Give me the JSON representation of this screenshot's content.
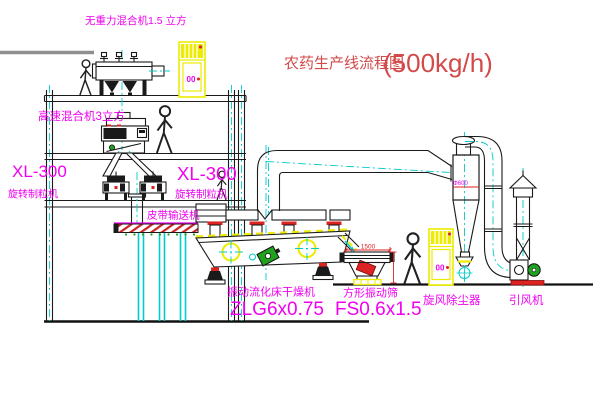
{
  "title": {
    "text": "农药生产线流程图",
    "capacity": "(500kg/h)"
  },
  "equipment_labels": {
    "gravity_mixer": "无重力混合机1.5 立方",
    "high_speed_mixer": "高速混合机3立方",
    "granulator_left": {
      "model": "XL-300",
      "name": "旋转制粒机"
    },
    "granulator_right": {
      "model": "XL-300",
      "name": "旋转制粒机"
    },
    "belt_conveyor": "皮带输送机",
    "fluid_bed_dryer": {
      "name": "振动流化床干燥机",
      "model": "ZLG6x0.75"
    },
    "vibrating_screen": {
      "name": "方形振动筛",
      "model": "FS0.6x1.5"
    },
    "cyclone": "旋风除尘器",
    "induced_draft_fan": "引风机"
  },
  "dimensions": {
    "screen_length": "1500",
    "cyclone_diameter": "Φ600"
  },
  "control_panels": {
    "panel_top": {
      "display": "00"
    },
    "panel_right": {
      "display": "00"
    }
  },
  "colors": {
    "label_magenta": "#F000F0",
    "title_red": "#D34A4A",
    "dimension_red": "#DD2222",
    "highlight_yellow": "#ECEC00",
    "centerline_cyan": "#00CCCC",
    "motor_green": "#1FA31F"
  }
}
